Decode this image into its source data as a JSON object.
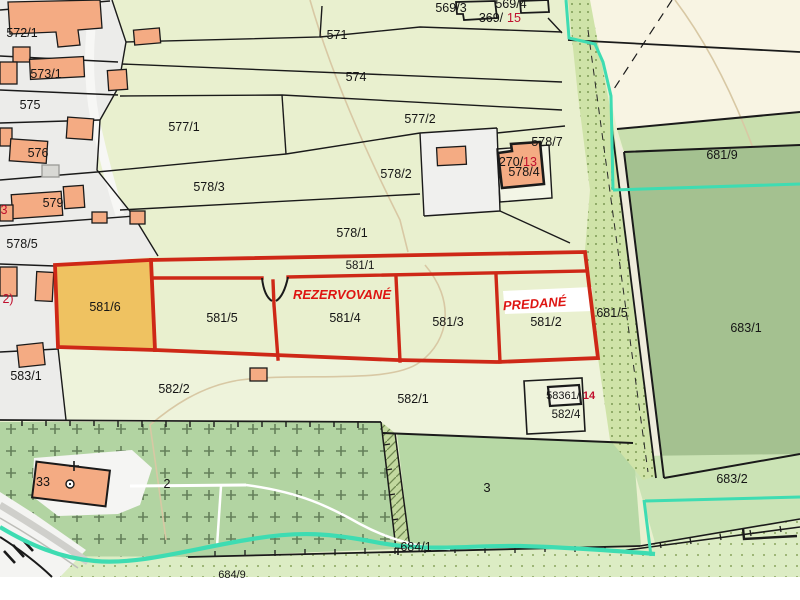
{
  "map": {
    "type": "cadastral-parcel-map",
    "status_labels": {
      "reserved": "REZERVOVANÉ",
      "sold": "PREDANÉ"
    },
    "colors": {
      "field_green": "#e9f0cf",
      "pale_green": "#eef3db",
      "village_gray": "#ececea",
      "cream": "#f8f4e3",
      "forest_dark": "#a4c190",
      "forest_mid": "#b7d8a5",
      "band_light": "#c9dfae",
      "orchard": "#b2d4a2",
      "stipple": "#cfe3a8",
      "bottom_band": "#dcecc4",
      "parcel_orange": "#efc261",
      "building_salmon": "#f4ab83",
      "boundary_red": "#ce2817",
      "water_cyan": "#3edcb2",
      "status_red": "#de1411",
      "number_red": "#c00f2d",
      "path_tan": "#d8c8a4",
      "line_black": "#1a1a1a"
    },
    "labels": [
      {
        "text": "572/1",
        "x": 22,
        "y": 37
      },
      {
        "text": "573/1",
        "x": 46,
        "y": 78
      },
      {
        "text": "575",
        "x": 30,
        "y": 109
      },
      {
        "text": "576",
        "x": 38,
        "y": 157
      },
      {
        "text": "579",
        "x": 53,
        "y": 207
      },
      {
        "text": "578/5",
        "x": 22,
        "y": 248
      },
      {
        "text": "583/1",
        "x": 26,
        "y": 380
      },
      {
        "text": "571",
        "x": 337,
        "y": 39
      },
      {
        "text": "574",
        "x": 356,
        "y": 81
      },
      {
        "text": "577/1",
        "x": 184,
        "y": 131
      },
      {
        "text": "577/2",
        "x": 420,
        "y": 123
      },
      {
        "text": "578/3",
        "x": 209,
        "y": 191
      },
      {
        "text": "578/2",
        "x": 396,
        "y": 178
      },
      {
        "text": "578/7",
        "x": 547,
        "y": 146
      },
      {
        "text": "270/",
        "x": 511,
        "y": 166
      },
      {
        "text": "13",
        "x": 530,
        "y": 166,
        "color": "#c00f2d"
      },
      {
        "text": "578/4",
        "x": 524,
        "y": 176
      },
      {
        "text": "569/3",
        "x": 451,
        "y": 12
      },
      {
        "text": "569/4",
        "x": 511,
        "y": 8
      },
      {
        "text": "369/",
        "x": 491,
        "y": 22
      },
      {
        "text": "15",
        "x": 514,
        "y": 22,
        "color": "#c00f2d"
      },
      {
        "text": "578/1",
        "x": 352,
        "y": 237
      },
      {
        "text": "581/1",
        "x": 360,
        "y": 269,
        "size": 11.5
      },
      {
        "text": "581/6",
        "x": 105,
        "y": 311
      },
      {
        "text": "581/5",
        "x": 222,
        "y": 322
      },
      {
        "text": "581/4",
        "x": 345,
        "y": 322
      },
      {
        "text": "581/3",
        "x": 448,
        "y": 326
      },
      {
        "text": "581/2",
        "x": 546,
        "y": 326
      },
      {
        "text": "681/5",
        "x": 612,
        "y": 317
      },
      {
        "text": "REZERVOVANÉ",
        "x": 342,
        "y": 299,
        "color": "#de1411",
        "size": 13,
        "bold": true,
        "italic": true
      },
      {
        "text": "PREDANÉ",
        "x": 535,
        "y": 308,
        "color": "#de1411",
        "size": 13,
        "bold": true,
        "italic": true,
        "rotate": -4
      },
      {
        "text": "582/2",
        "x": 174,
        "y": 393
      },
      {
        "text": "582/1",
        "x": 413,
        "y": 403
      },
      {
        "text": "582/4",
        "x": 566,
        "y": 418,
        "size": 11.5
      },
      {
        "text": "58361/",
        "x": 563,
        "y": 399,
        "size": 11
      },
      {
        "text": "14",
        "x": 589,
        "y": 399,
        "size": 11,
        "color": "#c00f2d",
        "bold": true
      },
      {
        "text": "3",
        "x": 487,
        "y": 492,
        "size": 13
      },
      {
        "text": "2",
        "x": 167,
        "y": 488
      },
      {
        "text": "33",
        "x": 43,
        "y": 486
      },
      {
        "text": "681/9",
        "x": 722,
        "y": 159
      },
      {
        "text": "683/1",
        "x": 746,
        "y": 332
      },
      {
        "text": "683/2",
        "x": 732,
        "y": 483
      },
      {
        "text": "684/1",
        "x": 416,
        "y": 551
      },
      {
        "text": "684/9",
        "x": 232,
        "y": 578,
        "size": 11
      },
      {
        "text": "3",
        "x": 4,
        "y": 214,
        "color": "#c00f2d"
      },
      {
        "text": "2)",
        "x": 8,
        "y": 303,
        "color": "#c00f2d"
      }
    ]
  }
}
